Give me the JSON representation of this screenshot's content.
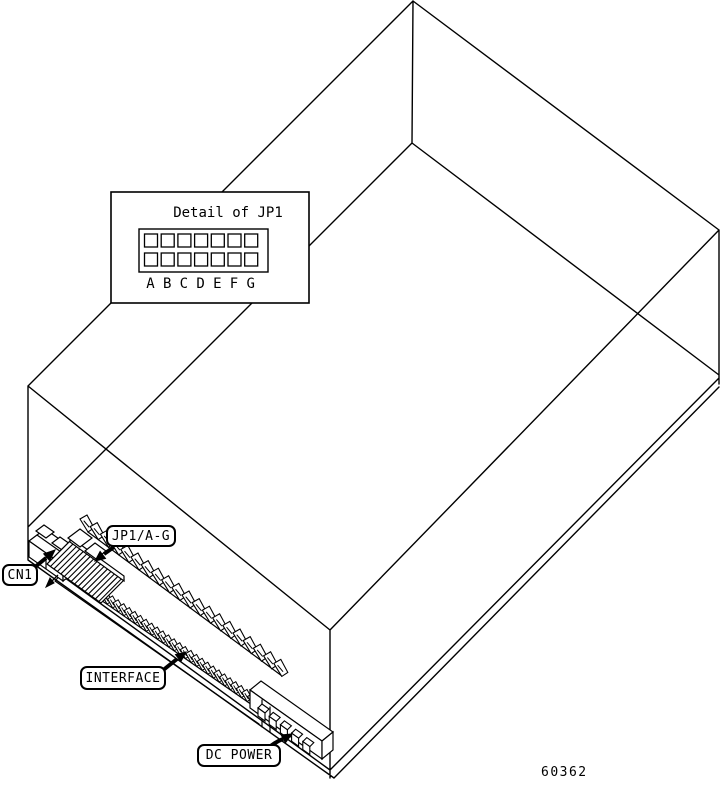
{
  "figure_number": "60362",
  "colors": {
    "line": "#000000",
    "background": "#ffffff"
  },
  "detail_panel": {
    "title": "Detail of JP1",
    "jumper_rows": 2,
    "jumper_cols": 7,
    "pin_labels": [
      "A",
      "B",
      "C",
      "D",
      "E",
      "F",
      "G"
    ]
  },
  "callouts": {
    "cn1": "CN1",
    "jp1": "JP1/A-G",
    "interface": "INTERFACE",
    "dc_power": "DC POWER"
  },
  "connectors": {
    "interface_pin_count": 20,
    "interface_contact_count": 28,
    "jp1_hatch_lines": 16,
    "dc_power_pin_count": 5
  }
}
